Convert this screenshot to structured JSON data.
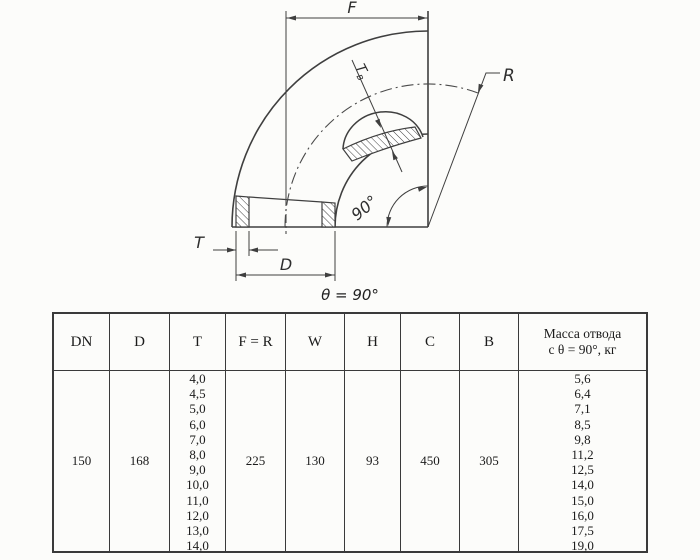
{
  "background_color": "#fcfcfa",
  "drawing": {
    "line_color": "#3f3f3f",
    "dim_f_label": "F",
    "dim_r_label": "R",
    "dim_t_label": "T",
    "dim_d_label": "D",
    "wall_label_main": "T",
    "wall_label_sub": "в",
    "angle_label": "90°",
    "theta_note": "θ = 90°"
  },
  "table": {
    "border_color": "#3a3a3a",
    "text_color": "#1b1b1b",
    "headers": {
      "dn": "DN",
      "d": "D",
      "t": "T",
      "fr": "F = R",
      "w": "W",
      "h": "H",
      "c": "C",
      "b": "B",
      "mass_line1": "Масса отвода",
      "mass_line2": "с θ =  90°, кг"
    },
    "row": {
      "dn": "150",
      "d": "168",
      "t_values": [
        "4,0",
        "4,5",
        "5,0",
        "6,0",
        "7,0",
        "8,0",
        "9,0",
        "10,0",
        "11,0",
        "12,0",
        "13,0",
        "14,0"
      ],
      "fr": "225",
      "w": "130",
      "h": "93",
      "c": "450",
      "b": "305",
      "mass_values": [
        "5,6",
        "6,4",
        "7,1",
        "8,5",
        "9,8",
        "11,2",
        "12,5",
        "14,0",
        "15,0",
        "16,0",
        "17,5",
        "19,0"
      ]
    }
  }
}
